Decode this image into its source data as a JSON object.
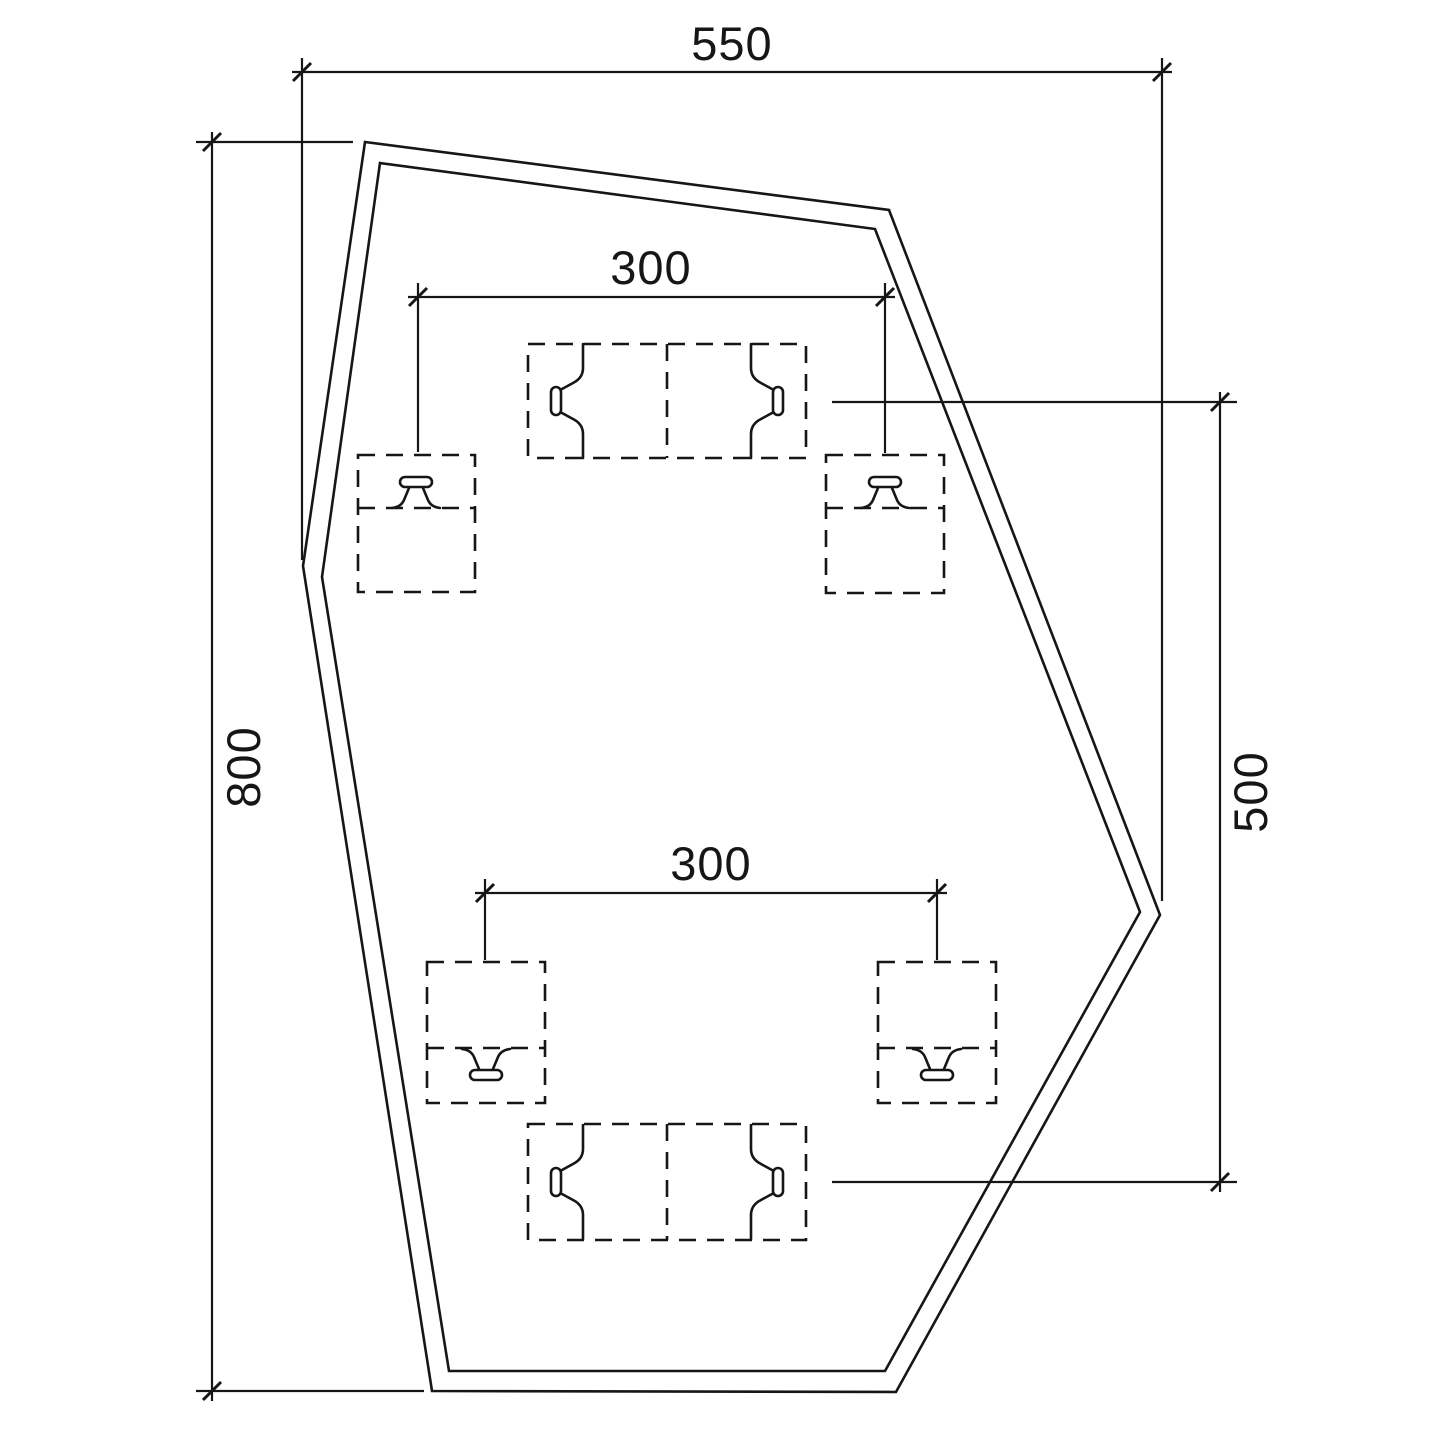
{
  "drawing": {
    "type": "cad-plan-drawing",
    "colors": {
      "background": "#ffffff",
      "line": "#161616"
    },
    "dimensions": {
      "top_width": "550",
      "left_height": "800",
      "right_height": "500",
      "upper_spacing": "300",
      "lower_spacing": "300"
    },
    "shape": {
      "outer_points": "365,142 889,210 1160,915 896,1392 432,1391 303,566",
      "inner_points": "380,163 875,229 1140,912 885,1371 449,1371 322,577"
    },
    "symbols": {
      "single_anchor_boxes": "4 dashed squares with T-profile section glyphs",
      "double_track_boxes": "2 dashed double rectangles with opposed T-profile section glyphs"
    }
  }
}
